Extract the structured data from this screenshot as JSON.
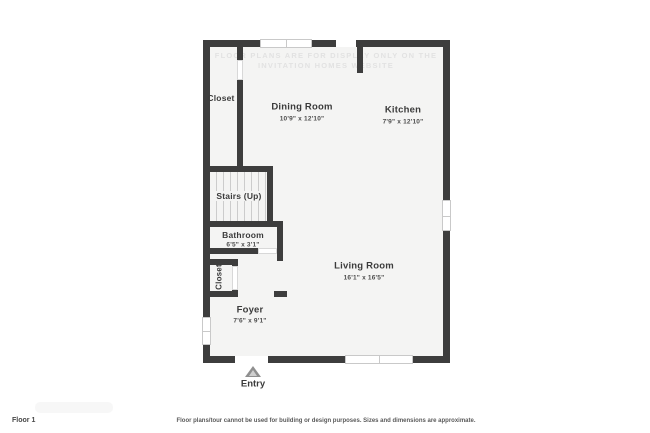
{
  "watermark": {
    "text": "FLOOR PLANS ARE FOR DISPLAY ONLY ON THE INVITATION HOMES WEBSITE"
  },
  "rooms": {
    "closet_top": {
      "name": "Closet"
    },
    "dining": {
      "name": "Dining Room",
      "dims": "10'9\" x 12'10\""
    },
    "kitchen": {
      "name": "Kitchen",
      "dims": "7'9\" x 12'10\""
    },
    "stairs": {
      "name": "Stairs (Up)"
    },
    "bathroom": {
      "name": "Bathroom",
      "dims": "6'5\" x 3'1\""
    },
    "closet_lower": {
      "name": "Closet"
    },
    "foyer": {
      "name": "Foyer",
      "dims": "7'6\" x 9'1\""
    },
    "living": {
      "name": "Living Room",
      "dims": "16'1\" x 16'5\""
    }
  },
  "entry": {
    "label": "Entry"
  },
  "footer": {
    "floor_label": "Floor 1",
    "disclaimer": "Floor plans/tour cannot be used for building or design purposes. Sizes and dimensions are approximate."
  },
  "colors": {
    "wall": "#3d3d3d",
    "floor": "#f4f4f3",
    "window_frame": "#c9c9c9",
    "label_text": "#3b3b3b"
  }
}
